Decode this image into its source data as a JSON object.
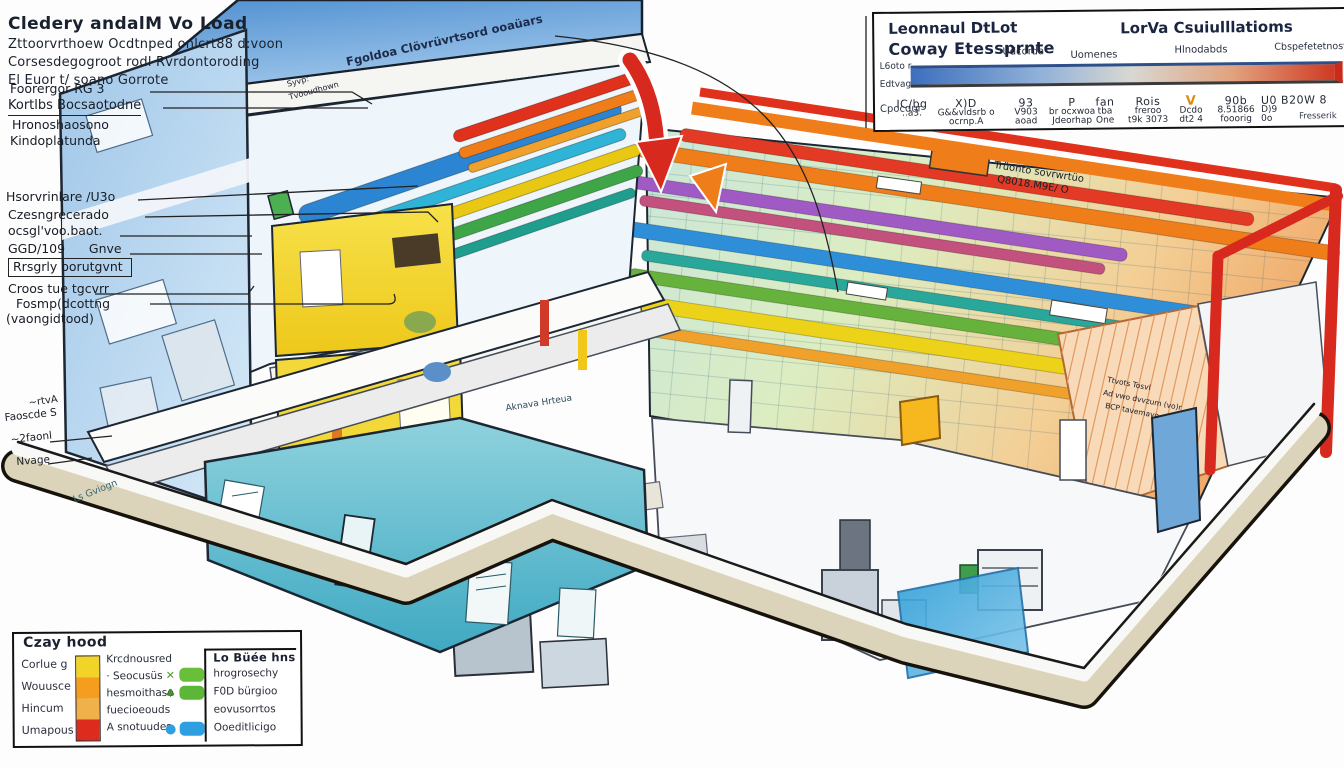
{
  "header": {
    "title": "Cledery andalM Vo Load",
    "lines": [
      "Zttoorvrthoew Ocdtnped onlcrt88 d:voon",
      "Corsesdegogroot rodl Rvrdontoroding",
      "El Euor t/ soano Gorrote",
      "Foorergor RG 3",
      "Kortlbs Bocsaotodne",
      "Hronoshaosono",
      "Kindoplatunda"
    ]
  },
  "callouts": {
    "lines": [
      "Hsorvrinlare /U3o",
      "Czesngrecerado",
      "ocsgl'voo.baot.",
      "GGD/109      Gnve",
      "Rrsgrly oorutgvnt",
      "Croos tue tgcvrr",
      "Fosmp(dcottng",
      "(vaongidtood)"
    ],
    "corner": [
      "~rtvA",
      "Faoscde S",
      "~2faonl",
      "Nvage"
    ]
  },
  "annotations": {
    "roof": "Fgoldoa Clövrüvrtsord ooaüars",
    "roof_small_1": "Syvp:",
    "roof_small_2": "Tvooudhown",
    "floor_1": "Trüonto sovrwrtüo",
    "floor_2": "Q8018.M9E/ O",
    "wall_1": "Ttvots Tosvl",
    "wall_2": "Ad vwo dvvzum (vo)r",
    "wall_3": "BCP tavemavo",
    "glass": "Aknava Hrteua",
    "base": "Ls Gviogn"
  },
  "panel": {
    "title_line1": "Leonnaul DtLot",
    "title_line2": "Coway Etessprnte",
    "title_right": "LorVa Csuiulllatioms",
    "col_headers": [
      "Udcorda",
      "Uomenes",
      "Hlnodabds",
      "Cbspefetetnost"
    ],
    "scale_top": "L6oto r",
    "scale_bottom": "Edtvago",
    "row_label": "Cpocdur",
    "gradient_colors": [
      "#3c6fbe",
      "#d8d8d2",
      "#cf3a23"
    ],
    "columns": [
      {
        "a": "IC/bg",
        "b": "..a3.",
        "c": ""
      },
      {
        "a": "X)D",
        "b": "G&&vldsrb o",
        "c": "ocrnp.A"
      },
      {
        "a": "93",
        "b": "V903",
        "c": "aoad"
      },
      {
        "a": "P",
        "b": "br ocxwoa",
        "c": "Jdeorhap"
      },
      {
        "a": "fan",
        "b": "tba",
        "c": "One"
      },
      {
        "a": "Rois",
        "b": "freroo",
        "c": "t9k 3073"
      },
      {
        "a": "V",
        "b": "Dcdo",
        "c": "dt2 4"
      },
      {
        "a": "90b",
        "b": "8.51866",
        "c": "fooorig"
      },
      {
        "a": "U0 B20W 8",
        "b": "D)9",
        "c": "0o"
      }
    ],
    "footnote": "Fresserik"
  },
  "legend": {
    "title": "Czay hood",
    "left_labels": [
      "Corlue g",
      "Wouusce",
      "Hincum",
      "Umapous"
    ],
    "left_texts": [
      "Krcdnousred",
      "· Seocusüs",
      "hesmoithase",
      "fuecioeouds",
      "A snotuudes"
    ],
    "bar_colors": [
      "#f2d327",
      "#f59d1e",
      "#f0b04a",
      "#dd2c1d"
    ],
    "right_title": "Lo Büée hns",
    "right_rows": [
      {
        "icon": "x-icon",
        "glyph": "✕",
        "swatch": "#6abf3a",
        "label": "hrogrosechy"
      },
      {
        "icon": "leaf-icon",
        "glyph": "♣",
        "swatch": "#5cb637",
        "label": "F0D bürgioo"
      },
      {
        "icon": "",
        "glyph": "",
        "swatch": "",
        "label": "eovusorrtos"
      },
      {
        "icon": "drop-icon",
        "glyph": "●",
        "swatch": "#2e9fe0",
        "label": "Ooeditlicigo"
      }
    ]
  }
}
